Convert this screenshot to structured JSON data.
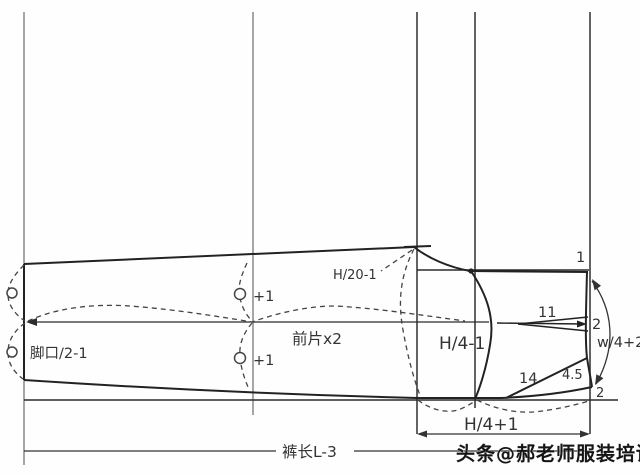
{
  "diagram": {
    "type": "trouser-front-pattern-draft",
    "piece_label": "前片x2",
    "measurements": {
      "hem_width": "脚口/2-1",
      "knee_ease_upper": "+1",
      "knee_ease_lower": "+1",
      "front_crotch_width": "H/20-1",
      "hip_width": "H/4-1",
      "rise_depth": "H/4+1",
      "trouser_length": "裤长L-3",
      "waist_width": "w/4+2",
      "front_waist_drop": "1",
      "dart_length": "11",
      "dart_intake": "2",
      "pocket_opening": "14",
      "pocket_top_width": "4.5",
      "side_seam_raise": "2"
    },
    "watermark": "头条@郝老师服装培训",
    "colors": {
      "outline": "#222222",
      "guide": "#444444",
      "grid_light": "#909090",
      "grid_dark": "#3c3c3c",
      "text": "#333333",
      "background": "#fefefe"
    }
  }
}
